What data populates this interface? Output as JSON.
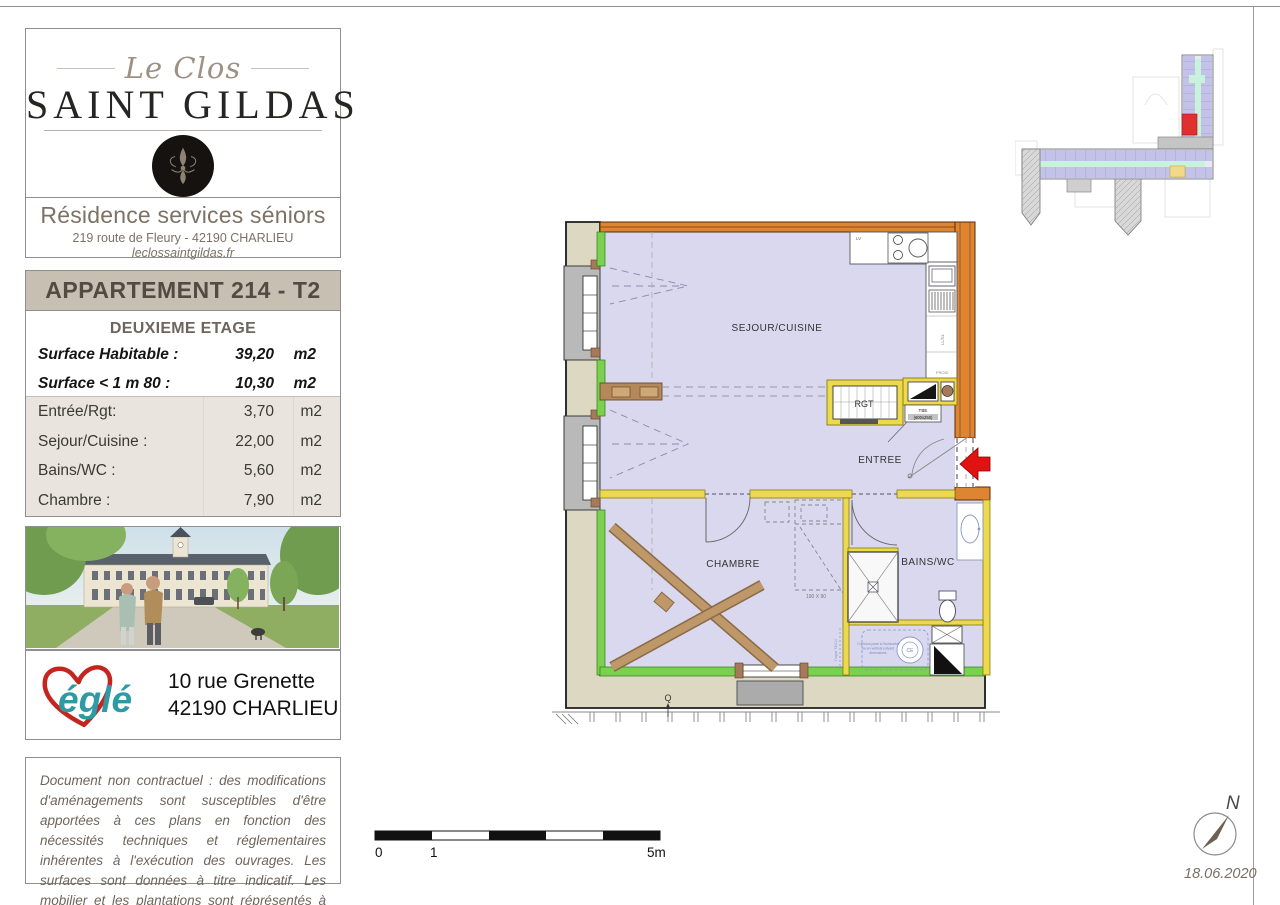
{
  "branding": {
    "script_name": "Le Clos",
    "main_name": "SAINT GILDAS",
    "tagline": "Résidence services séniors",
    "address": "219 route de Fleury - 42190 CHARLIEU",
    "website": "leclossaintgildas.fr"
  },
  "apartment": {
    "title": "APPARTEMENT 214 - T2",
    "floor": "DEUXIEME ETAGE",
    "surfaces": [
      {
        "label": "Surface Habitable :",
        "value": "39,20",
        "unit": "m2"
      },
      {
        "label": "Surface < 1 m 80 :",
        "value": "10,30",
        "unit": "m2"
      }
    ],
    "rooms": [
      {
        "label": "Entrée/Rgt:",
        "value": "3,70",
        "unit": "m2"
      },
      {
        "label": "Sejour/Cuisine :",
        "value": "22,00",
        "unit": "m2"
      },
      {
        "label": "Bains/WC :",
        "value": "5,60",
        "unit": "m2"
      },
      {
        "label": "Chambre :",
        "value": "7,90",
        "unit": "m2"
      }
    ]
  },
  "agency": {
    "name": "églé",
    "address_line1": "10 rue Grenette",
    "address_line2": "42190 CHARLIEU"
  },
  "disclaimer": "Document non contractuel : des modifications d'aménagements sont susceptibles d'être apportées à ces plans en fonction des nécessités techniques et réglementaires inhérentes à l'exécution des ouvrages. Les surfaces sont données à titre indicatif. Les mobilier et les plantations sont réprésentés à titre indicatif.",
  "floorplan": {
    "labels": {
      "sejour": "SEJOUR/CUISINE",
      "rgt": "RGT",
      "entree": "ENTREE",
      "chambre": "CHAMBRE",
      "bains": "BAINS/WC",
      "lv": "LV",
      "froid": "FROID",
      "llsl": "LL/SL",
      "tde": "TBE",
      "tde_size": "(600x250)",
      "bed_size": "190 X 90",
      "ce": "CE",
      "cumulus_line1": "Cumulus posé à l'horizontal",
      "cumulus_line2": "ou en vertical suivant",
      "cumulus_line3": "dimensions",
      "trappe": "Trappe 73x110",
      "q_mark": "Q"
    },
    "colors": {
      "exterior_wall": "#dd8530",
      "partition_wall": "#ecd94e",
      "insulated_wall": "#79d14e",
      "floor_fill": "#d9d8ef",
      "exterior_band": "#ddd8c1",
      "highlight_unit": "#e03030",
      "entry_arrow": "#e01212"
    }
  },
  "scalebar": {
    "tick0": "0",
    "tick1": "1",
    "tick5": "5m"
  },
  "compass": {
    "north": "N",
    "date": "18.06.2020"
  }
}
